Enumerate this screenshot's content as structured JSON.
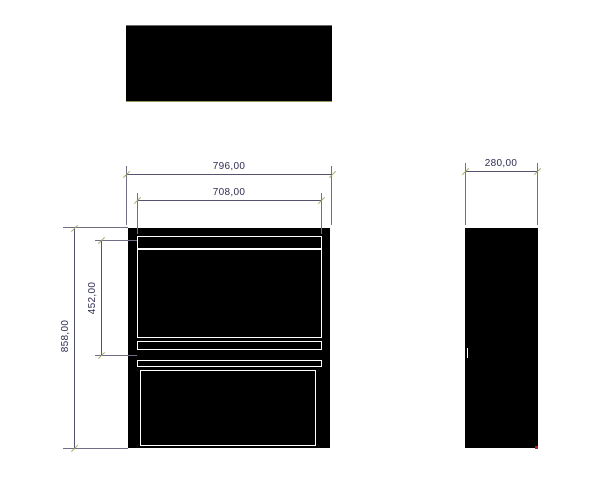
{
  "drawing": {
    "type": "technical-orthographic-views",
    "views": {
      "top": "top-view",
      "front": "front-view",
      "side": "side-view"
    },
    "dims": {
      "front_width": "796,00",
      "front_opening_width": "708,00",
      "depth": "280,00",
      "height": "858,00",
      "opening_height": "452,00"
    },
    "colors": {
      "background": "#ffffff",
      "shape_fill": "#000000",
      "panel_outline": "#ffffff",
      "dimension_line": "#53536e",
      "extension_line": "#6f6f85",
      "dimension_text": "#2e2e52",
      "tick": "#a8a860",
      "endpoint_marker": "#b02020"
    }
  }
}
